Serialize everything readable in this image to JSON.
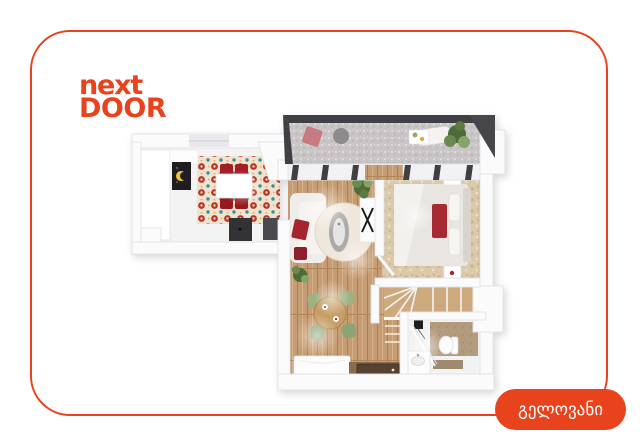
{
  "page": {
    "background": "#ffffff"
  },
  "card": {
    "background": "#ffffff",
    "border_color": "#e8431d",
    "corner_radius_px": 40
  },
  "logo": {
    "line1": "next",
    "line2": "DOOR",
    "color": "#e8431d"
  },
  "badge": {
    "label": "გელოვანი",
    "background": "#e8431d",
    "text_color": "#ffffff"
  },
  "floor_plan": {
    "kind": "3d-top-down-apartment-render",
    "rooms": [
      "kitchen",
      "balcony",
      "living-room",
      "bedroom",
      "bathroom",
      "stairs",
      "entry"
    ],
    "furniture": [
      "kitchen-counter",
      "cooktop",
      "kitchen-table",
      "red-chairs",
      "oven",
      "sofa",
      "red-pillows",
      "round-rug",
      "coffee-table",
      "tv-console",
      "dining-table",
      "green-chairs",
      "plants",
      "bed",
      "nightstands",
      "console-cabinet",
      "toilet",
      "shower",
      "sink",
      "lounge-chair",
      "pouf"
    ],
    "colors": {
      "wall": "#fbfbfc",
      "wall_shadow": "#e3e3e7",
      "wood_floor": "#c59c73",
      "balcony_floor": "#c9c4c6",
      "tile_base": "#efe2d0",
      "tile_accent_red": "#b7372e",
      "tile_accent_teal": "#3f8f8e",
      "rug_beige": "#dbc9ab",
      "accent_red": "#a52a33",
      "chair_green": "#9db183",
      "plant_green": "#4e6b3a",
      "dark_frame": "#3f3f44",
      "stairs_wood": "#cda97e",
      "entry_door": "#56422f",
      "shower_floor": "#b29a7d",
      "cooktop_black": "#1e1e22"
    }
  }
}
